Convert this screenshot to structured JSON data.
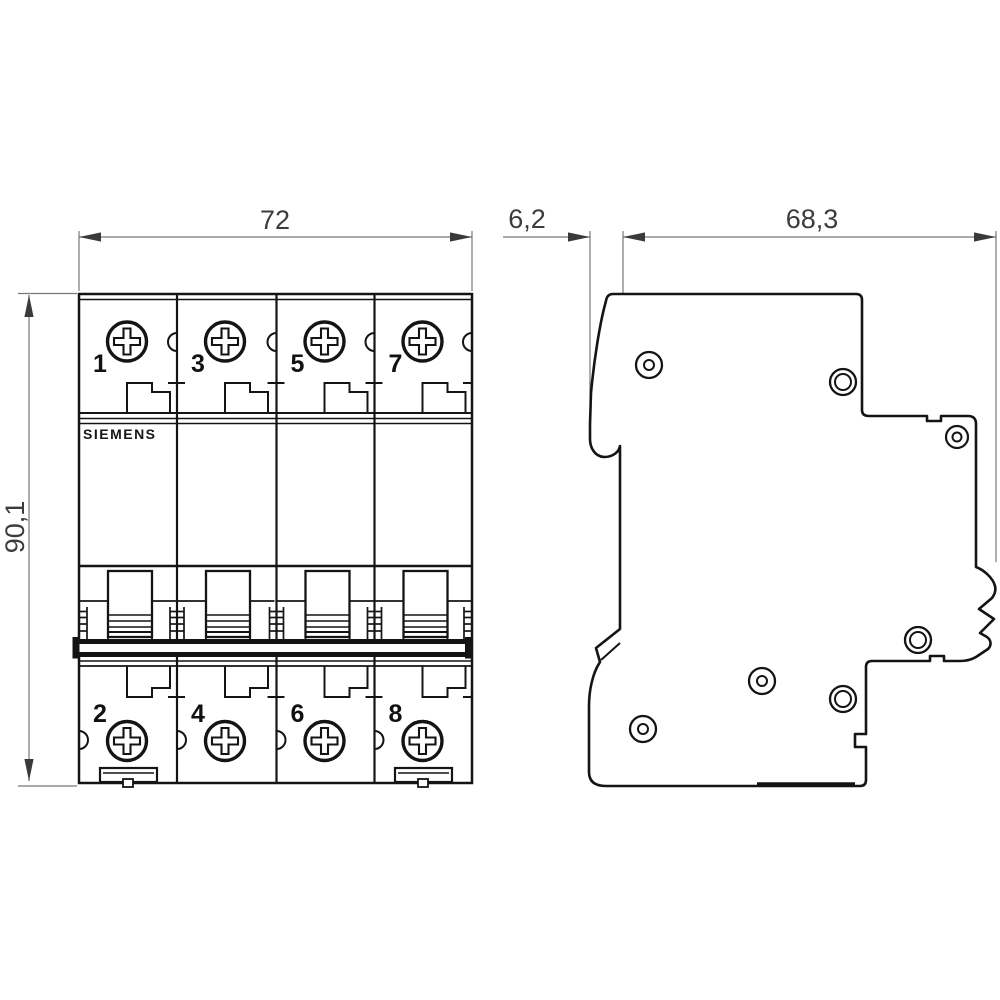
{
  "drawing": {
    "title": "Miniature circuit breaker dimensional drawing",
    "brand": "SIEMENS",
    "views": {
      "front": {
        "label": "front-view",
        "pole_terminal_labels_top": [
          "1",
          "3",
          "5",
          "7"
        ],
        "pole_terminal_labels_bottom": [
          "2",
          "4",
          "6",
          "8"
        ],
        "modules": 4
      },
      "side": {
        "label": "side-view"
      }
    },
    "dimensions": {
      "width_mm": "72",
      "rail_offset_mm": "6,2",
      "depth_mm": "68,3",
      "height_mm": "90,1"
    },
    "icons": {
      "screw": "phillips-screw-icon",
      "rivet": "rivet-hole-icon",
      "toggle": "toggle-switch",
      "clip": "mounting-clip",
      "latch": "din-rail-latch"
    },
    "colors": {
      "line": "#141414",
      "dimension_line": "#787878",
      "dimension_text": "#3c3c3c",
      "background": "#ffffff"
    }
  }
}
